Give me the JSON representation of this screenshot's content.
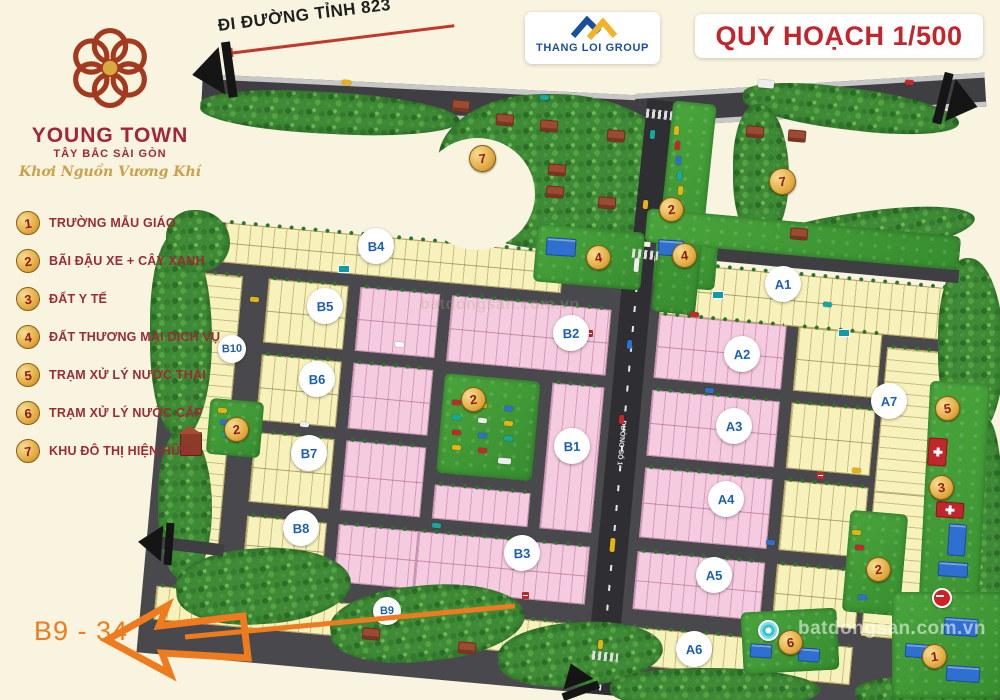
{
  "title": "QUY HOẠCH 1/500",
  "developer": {
    "name": "THANG LOI GROUP"
  },
  "project": {
    "name": "YOUNG TOWN",
    "subtitle": "TÂY BẮC SÀI GÒN",
    "slogan": "Khơi Nguồn Vương Khí"
  },
  "top_road_label": "ĐI ĐƯỜNG TỈNH 823",
  "legend": {
    "items": [
      {
        "num": "1",
        "label": "TRƯỜNG MẪU GIÁO"
      },
      {
        "num": "2",
        "label": "BÃI ĐẬU XE + CÂY XANH"
      },
      {
        "num": "3",
        "label": "ĐẤT Y TẾ"
      },
      {
        "num": "4",
        "label": "ĐẤT THƯƠNG MẠI DỊCH VỤ"
      },
      {
        "num": "5",
        "label": "TRẠM XỬ LÝ NƯỚC THẢI"
      },
      {
        "num": "6",
        "label": "TRẠM XỬ LÝ NƯỚC CẤP"
      },
      {
        "num": "7",
        "label": "KHU ĐÔ THỊ HIỆN HỮU"
      }
    ]
  },
  "blocks": [
    {
      "label": "B4"
    },
    {
      "label": "B10"
    },
    {
      "label": "B5"
    },
    {
      "label": "B6"
    },
    {
      "label": "B7"
    },
    {
      "label": "B8"
    },
    {
      "label": "B2"
    },
    {
      "label": "B1"
    },
    {
      "label": "B3"
    },
    {
      "label": "B9"
    },
    {
      "label": "A1"
    },
    {
      "label": "A2"
    },
    {
      "label": "A3"
    },
    {
      "label": "A4"
    },
    {
      "label": "A5"
    },
    {
      "label": "A6"
    },
    {
      "label": "A7"
    }
  ],
  "badges": [
    {
      "num": "7"
    },
    {
      "num": "7"
    },
    {
      "num": "2"
    },
    {
      "num": "4"
    },
    {
      "num": "4"
    },
    {
      "num": "2"
    },
    {
      "num": "2"
    },
    {
      "num": "2"
    },
    {
      "num": "5"
    },
    {
      "num": "3"
    },
    {
      "num": "6"
    },
    {
      "num": "1"
    }
  ],
  "streets": {
    "main_road": "ĐƯỜNG SỐ 1"
  },
  "annotation": {
    "text": "B9 - 34"
  },
  "watermark": "batdongsan.com.vn",
  "colors": {
    "accent_orange": "#ee7b1e",
    "title_red": "#c4242b",
    "legend_red": "#9c2b34",
    "lot_yellow": "#f7f2bb",
    "lot_pink": "#f4cbdf",
    "road": "#49494d",
    "park_green": "#3f9f35",
    "badge_gold": "#e0a83e",
    "block_label_blue": "#1b5fae"
  }
}
